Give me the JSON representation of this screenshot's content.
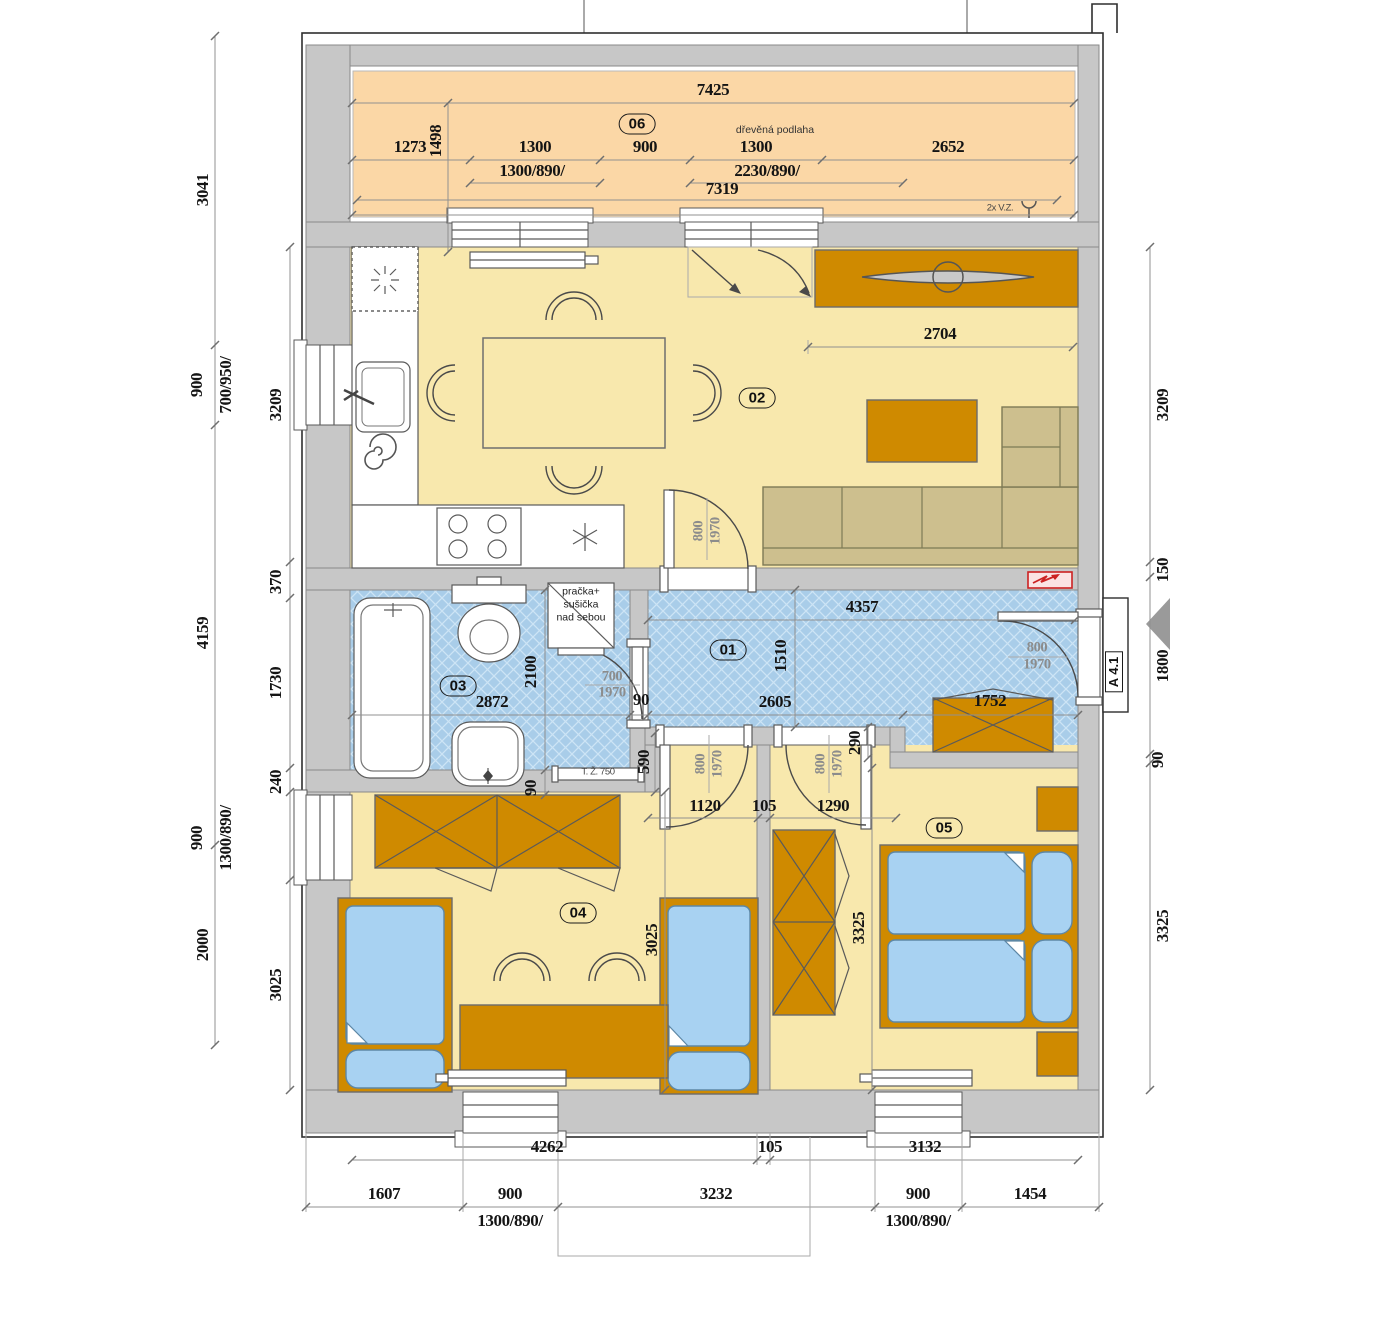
{
  "rooms": {
    "r01": "01",
    "r02": "02",
    "r03": "03",
    "r04": "04",
    "r05": "05",
    "r06": "06"
  },
  "texts": {
    "wood_floor": "dřevěná podlaha",
    "vz": "2x V.Z.",
    "towel_rail": "T. Ž. 750",
    "washer_line1": "pračka+",
    "washer_line2": "sušička",
    "washer_line3": "nad sebou",
    "entry_ref": "A 4.1"
  },
  "doors": {
    "w800": "800",
    "w700": "700",
    "h1970": "1970"
  },
  "dims": {
    "t7425": "7425",
    "t1273": "1273",
    "t1498": "1498",
    "t1300a": "1300",
    "t900": "900",
    "t1300b": "1300",
    "t2652": "2652",
    "twin1": "1300/890/",
    "twin2": "2230/890/",
    "t7319": "7319",
    "l3041": "3041",
    "l900": "900",
    "lwin": "700/950/",
    "l3209": "3209",
    "l370": "370",
    "l4159": "4159",
    "l1730": "1730",
    "l240": "240",
    "l900b": "900",
    "lwin2": "1300/890/",
    "l3025": "3025",
    "l2000": "2000",
    "r3209": "3209",
    "r150": "150",
    "r1800": "1800",
    "r90": "90",
    "r3325": "3325",
    "liv2704": "2704",
    "hall4357": "4357",
    "hall1510": "1510",
    "hall2605": "2605",
    "hall90": "90",
    "hall1752": "1752",
    "v290": "290",
    "bath2872": "2872",
    "bath2100": "2100",
    "bath590": "590",
    "bath90": "90",
    "d1120": "1120",
    "d105": "105",
    "d1290": "1290",
    "b4262": "4262",
    "b105": "105",
    "b3132": "3132",
    "b1607": "1607",
    "b900a": "900",
    "b3232": "3232",
    "b900b": "900",
    "b1454": "1454",
    "bwin": "1300/890/"
  },
  "colors": {
    "terrace": "#fbd7a6",
    "room_yellow": "#f8e8ad",
    "room_blue": "#a9cde9",
    "wall": "#c7c7c7",
    "furniture": "#cf8a00",
    "sofa": "#cdbf8e",
    "mattress": "#a8d2f2",
    "electro_red": "#cc2222"
  }
}
